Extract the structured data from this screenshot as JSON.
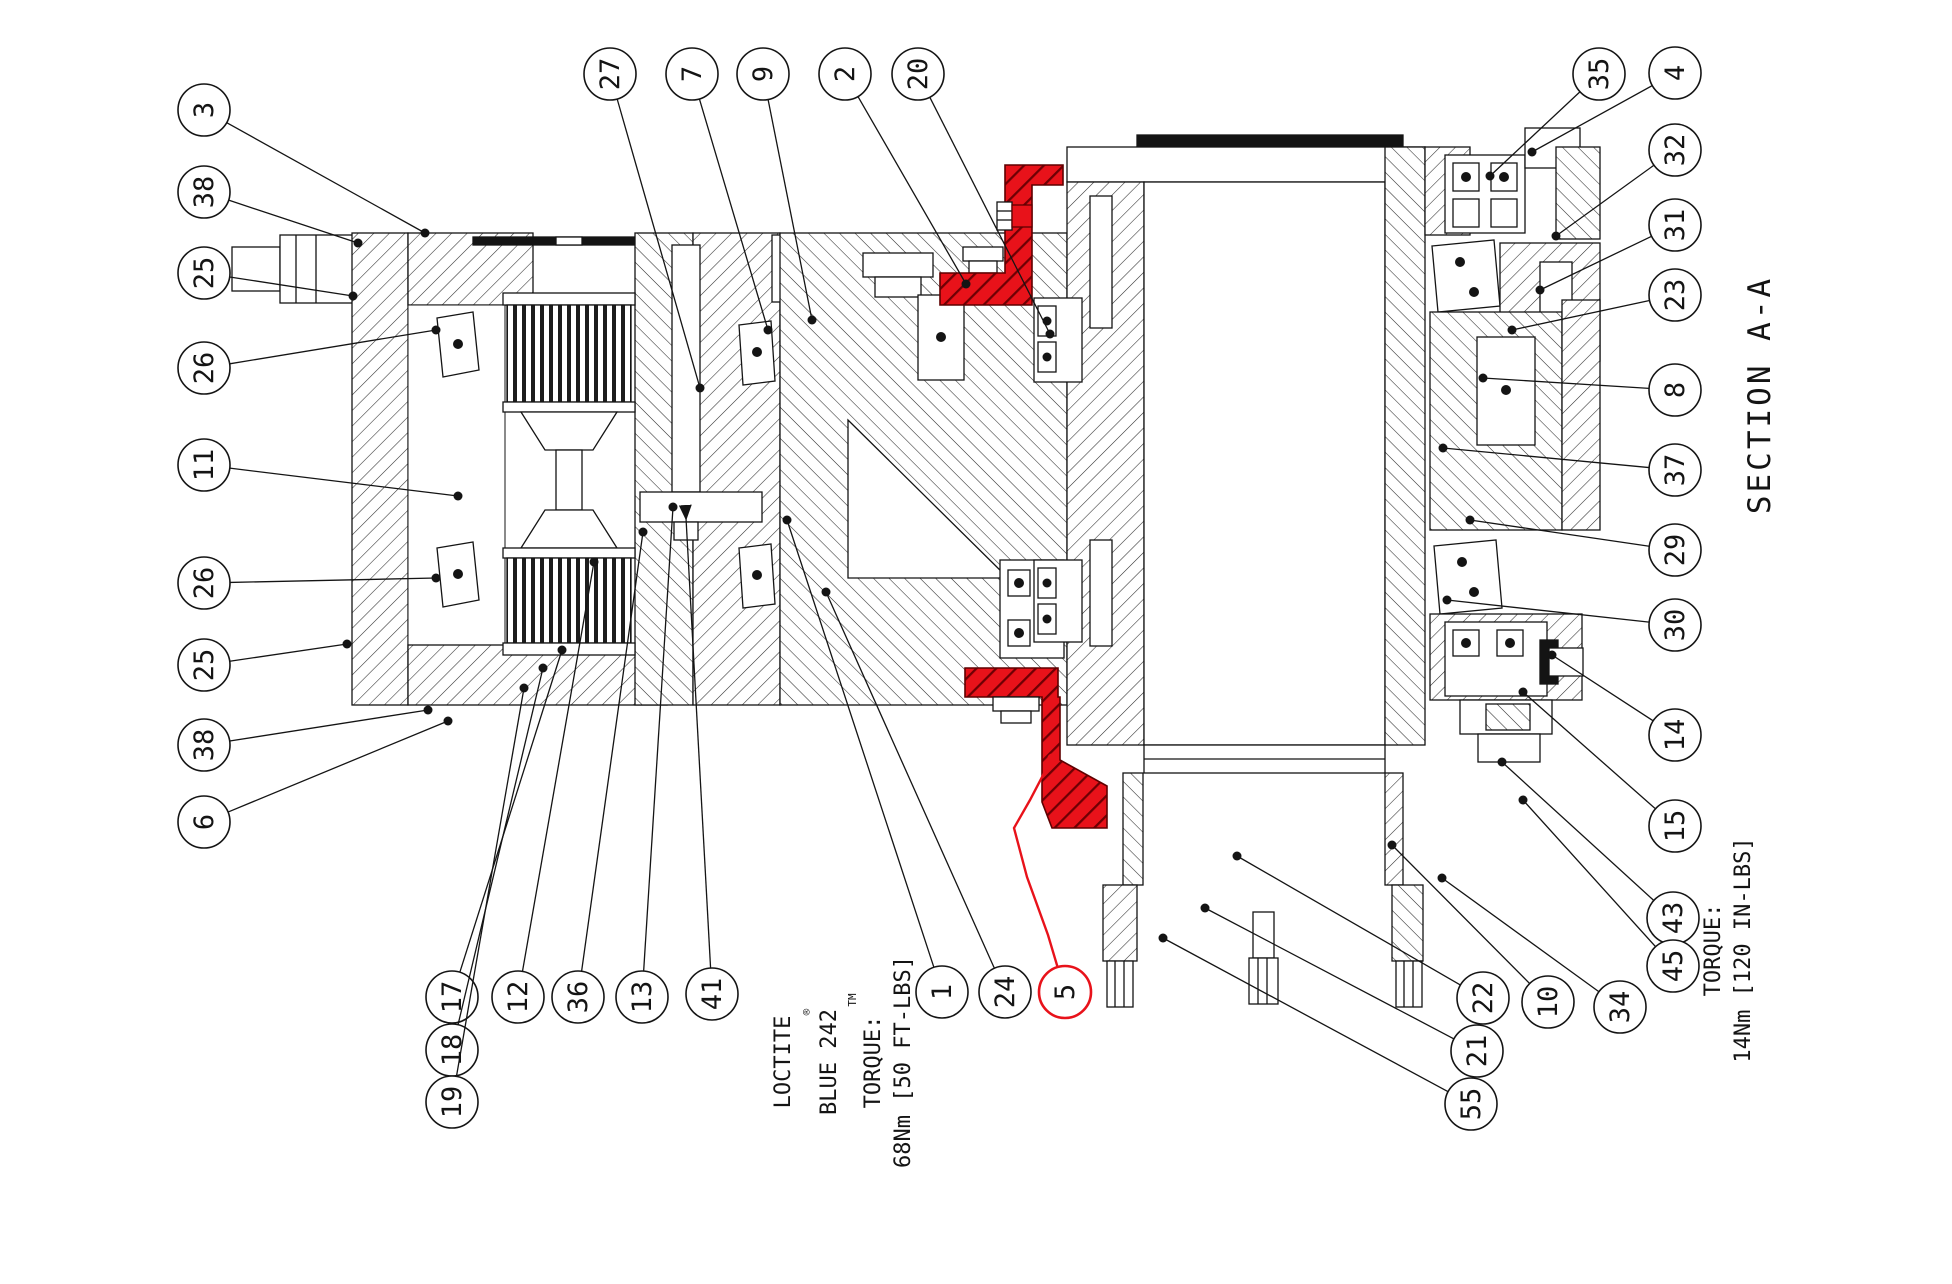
{
  "colors": {
    "line": "#141414",
    "hatch": "#2e2e2e",
    "highlight": "#e8121a",
    "highlight_dark": "#5f0000",
    "background": "#ffffff"
  },
  "section_label": "SECTION A-A",
  "notes": {
    "left": {
      "line1": "LOCTITE",
      "reg": "®",
      "line2": "BLUE 242",
      "tm": "TM",
      "line3": "TORQUE:",
      "line4": "68Nm [50 FT-LBS]"
    },
    "right": {
      "line1": "TORQUE:",
      "line2": "14Nm [120 IN-LBS]"
    }
  },
  "balloons": [
    {
      "id": "3",
      "n": "3",
      "x": 204,
      "y": 110,
      "tx": 425,
      "ty": 233
    },
    {
      "id": "38-a",
      "n": "38",
      "x": 204,
      "y": 192,
      "tx": 358,
      "ty": 243
    },
    {
      "id": "25-a",
      "n": "25",
      "x": 204,
      "y": 273,
      "tx": 353,
      "ty": 296
    },
    {
      "id": "26-a",
      "n": "26",
      "x": 204,
      "y": 368,
      "tx": 436,
      "ty": 330
    },
    {
      "id": "11",
      "n": "11",
      "x": 204,
      "y": 465,
      "tx": 458,
      "ty": 496
    },
    {
      "id": "26-b",
      "n": "26",
      "x": 204,
      "y": 583,
      "tx": 436,
      "ty": 578
    },
    {
      "id": "25-b",
      "n": "25",
      "x": 204,
      "y": 665,
      "tx": 347,
      "ty": 644
    },
    {
      "id": "38-b",
      "n": "38",
      "x": 204,
      "y": 745,
      "tx": 428,
      "ty": 710
    },
    {
      "id": "6",
      "n": "6",
      "x": 204,
      "y": 822,
      "tx": 448,
      "ty": 721
    },
    {
      "id": "27",
      "n": "27",
      "x": 610,
      "y": 74,
      "tx": 700,
      "ty": 388
    },
    {
      "id": "7",
      "n": "7",
      "x": 692,
      "y": 74,
      "tx": 768,
      "ty": 330
    },
    {
      "id": "9",
      "n": "9",
      "x": 763,
      "y": 74,
      "tx": 812,
      "ty": 320
    },
    {
      "id": "2",
      "n": "2",
      "x": 845,
      "y": 74,
      "tx": 966,
      "ty": 284
    },
    {
      "id": "20",
      "n": "20",
      "x": 918,
      "y": 74,
      "tx": 1050,
      "ty": 334
    },
    {
      "id": "35",
      "n": "35",
      "x": 1599,
      "y": 74,
      "tx": 1490,
      "ty": 176
    },
    {
      "id": "4",
      "n": "4",
      "x": 1675,
      "y": 73,
      "tx": 1532,
      "ty": 152
    },
    {
      "id": "32",
      "n": "32",
      "x": 1675,
      "y": 150,
      "tx": 1556,
      "ty": 236
    },
    {
      "id": "31",
      "n": "31",
      "x": 1675,
      "y": 225,
      "tx": 1540,
      "ty": 290
    },
    {
      "id": "23",
      "n": "23",
      "x": 1675,
      "y": 295,
      "tx": 1512,
      "ty": 330
    },
    {
      "id": "8",
      "n": "8",
      "x": 1675,
      "y": 390,
      "tx": 1483,
      "ty": 378
    },
    {
      "id": "37",
      "n": "37",
      "x": 1675,
      "y": 470,
      "tx": 1443,
      "ty": 448
    },
    {
      "id": "29",
      "n": "29",
      "x": 1675,
      "y": 550,
      "tx": 1470,
      "ty": 520
    },
    {
      "id": "30",
      "n": "30",
      "x": 1675,
      "y": 625,
      "tx": 1447,
      "ty": 600
    },
    {
      "id": "14",
      "n": "14",
      "x": 1675,
      "y": 735,
      "tx": 1552,
      "ty": 655
    },
    {
      "id": "15",
      "n": "15",
      "x": 1675,
      "y": 826,
      "tx": 1523,
      "ty": 692
    },
    {
      "id": "43",
      "n": "43",
      "x": 1673,
      "y": 918,
      "tx": 1502,
      "ty": 762
    },
    {
      "id": "45",
      "n": "45",
      "x": 1673,
      "y": 966,
      "tx": 1523,
      "ty": 800
    },
    {
      "id": "34",
      "n": "34",
      "x": 1620,
      "y": 1007,
      "tx": 1442,
      "ty": 878
    },
    {
      "id": "10",
      "n": "10",
      "x": 1548,
      "y": 1002,
      "tx": 1392,
      "ty": 845
    },
    {
      "id": "22",
      "n": "22",
      "x": 1483,
      "y": 998,
      "tx": 1237,
      "ty": 856
    },
    {
      "id": "21",
      "n": "21",
      "x": 1477,
      "y": 1051,
      "tx": 1205,
      "ty": 908
    },
    {
      "id": "55",
      "n": "55",
      "x": 1471,
      "y": 1104,
      "tx": 1163,
      "ty": 938
    },
    {
      "id": "17",
      "n": "17",
      "x": 452,
      "y": 997,
      "tx": 562,
      "ty": 650
    },
    {
      "id": "18",
      "n": "18",
      "x": 452,
      "y": 1050,
      "tx": 543,
      "ty": 668
    },
    {
      "id": "19",
      "n": "19",
      "x": 452,
      "y": 1102,
      "tx": 524,
      "ty": 688
    },
    {
      "id": "12",
      "n": "12",
      "x": 518,
      "y": 997,
      "tx": 594,
      "ty": 562
    },
    {
      "id": "36",
      "n": "36",
      "x": 578,
      "y": 997,
      "tx": 643,
      "ty": 532
    },
    {
      "id": "13",
      "n": "13",
      "x": 642,
      "y": 997,
      "tx": 673,
      "ty": 507
    },
    {
      "id": "41",
      "n": "41",
      "x": 712,
      "y": 994,
      "tx": 686,
      "ty": 518,
      "arrow": true
    },
    {
      "id": "1",
      "n": "1",
      "x": 942,
      "y": 992,
      "tx": 787,
      "ty": 520
    },
    {
      "id": "24",
      "n": "24",
      "x": 1005,
      "y": 992,
      "tx": 826,
      "ty": 592
    },
    {
      "id": "5",
      "n": "5",
      "x": 1065,
      "y": 992,
      "tx": 1052,
      "ty": 758,
      "highlight": true,
      "via": [
        [
          1030,
          800
        ],
        [
          1014,
          828
        ],
        [
          1027,
          877
        ],
        [
          1048,
          935
        ]
      ]
    }
  ]
}
